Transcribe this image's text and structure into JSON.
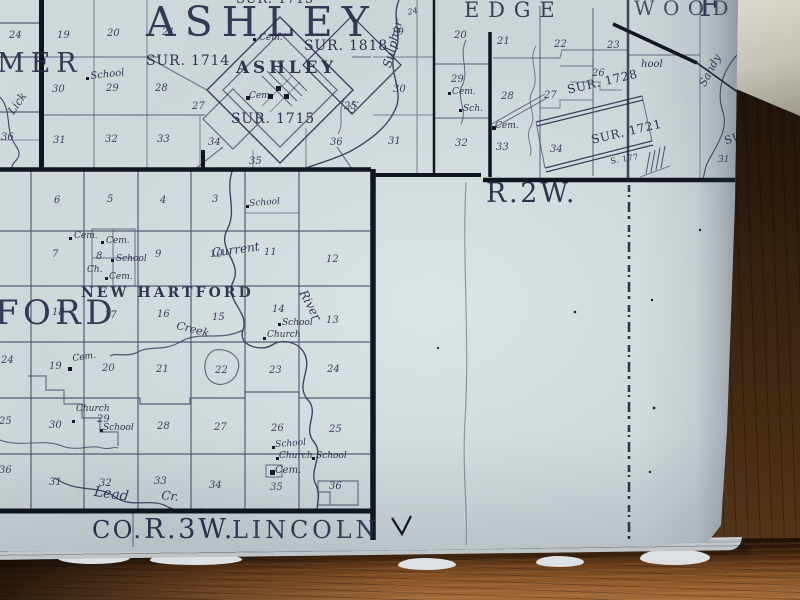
{
  "colors": {
    "ink": "#212b46",
    "ink_heavy": "#10151f",
    "paper": "#ccd4d8",
    "paper_bright": "#d8dfe2",
    "wood_dark": "#2e1a0c",
    "wood_mid": "#5a3a1d",
    "wood_light": "#9a6233",
    "object_light": "#dcd9cf"
  },
  "map": {
    "border_labels": {
      "range_right": "R.2W.",
      "bottom_county": "CO.",
      "bottom_range": "R.3W.",
      "bottom_township": "LINCOLN"
    },
    "labels": [
      {
        "n": "survey-label",
        "t": "SUR. 1715",
        "x": 236,
        "y": -7,
        "fs": 13,
        "c": "sur"
      },
      {
        "n": "township-name-ashley",
        "t": "ASHLEY",
        "x": 146,
        "y": 2,
        "fs": 41,
        "c": "big"
      },
      {
        "n": "township-name-partial-mer",
        "t": "MER",
        "x": -3,
        "y": 50,
        "fs": 27,
        "c": "big"
      },
      {
        "n": "section-number",
        "t": "24",
        "x": 9,
        "y": 31,
        "c": "num"
      },
      {
        "n": "section-number",
        "t": "19",
        "x": 57,
        "y": 31,
        "c": "num"
      },
      {
        "n": "section-number",
        "t": "20",
        "x": 107,
        "y": 29,
        "c": "num"
      },
      {
        "n": "section-number",
        "t": "21",
        "x": 162,
        "y": 28,
        "c": "num"
      },
      {
        "n": "poi-label",
        "t": "School",
        "x": 90,
        "y": 72,
        "fs": 10,
        "c": "cur",
        "r": -6
      },
      {
        "n": "creek-name",
        "t": "Lick",
        "x": 6,
        "y": 110,
        "fs": 11,
        "c": "cur",
        "r": -55
      },
      {
        "n": "section-number",
        "t": "30",
        "x": 52,
        "y": 85,
        "c": "num"
      },
      {
        "n": "section-number",
        "t": "29",
        "x": 106,
        "y": 84,
        "c": "num"
      },
      {
        "n": "section-number",
        "t": "28",
        "x": 155,
        "y": 84,
        "c": "num"
      },
      {
        "n": "section-number",
        "t": "27",
        "x": 192,
        "y": 102,
        "c": "num"
      },
      {
        "n": "section-number",
        "t": "25",
        "x": 344,
        "y": 102,
        "c": "num"
      },
      {
        "n": "section-number",
        "t": "36",
        "x": 1,
        "y": 133,
        "c": "num"
      },
      {
        "n": "section-number",
        "t": "31",
        "x": 53,
        "y": 136,
        "c": "num"
      },
      {
        "n": "section-number",
        "t": "32",
        "x": 105,
        "y": 135,
        "c": "num"
      },
      {
        "n": "section-number",
        "t": "33",
        "x": 157,
        "y": 135,
        "c": "num"
      },
      {
        "n": "section-number",
        "t": "34",
        "x": 208,
        "y": 138,
        "c": "num"
      },
      {
        "n": "section-number",
        "t": "35",
        "x": 249,
        "y": 157,
        "c": "num"
      },
      {
        "n": "section-number",
        "t": "36",
        "x": 330,
        "y": 138,
        "c": "num"
      },
      {
        "n": "section-number",
        "t": "31",
        "x": 388,
        "y": 137,
        "c": "num"
      },
      {
        "n": "section-number",
        "t": "30",
        "x": 393,
        "y": 85,
        "c": "num"
      },
      {
        "n": "section-number",
        "t": "19",
        "x": 391,
        "y": 28,
        "c": "num"
      },
      {
        "n": "section-number",
        "t": "24",
        "x": 407,
        "y": 9,
        "fs": 8,
        "c": "num",
        "r": -12
      },
      {
        "n": "survey-label",
        "t": "SUR. 1714",
        "x": 146,
        "y": 54,
        "fs": 14,
        "c": "sur"
      },
      {
        "n": "survey-label",
        "t": "SUR. 1818",
        "x": 304,
        "y": 39,
        "fs": 14,
        "c": "sur"
      },
      {
        "n": "town-name-ashley",
        "t": "ASHLEY",
        "x": 236,
        "y": 60,
        "fs": 17,
        "c": "twn"
      },
      {
        "n": "survey-label",
        "t": "SUR. 1715",
        "x": 231,
        "y": 112,
        "fs": 14,
        "c": "sur"
      },
      {
        "n": "poi-label",
        "t": "Cem.",
        "x": 259,
        "y": 34,
        "c": "hand"
      },
      {
        "n": "poi-label",
        "t": "Cem.",
        "x": 249,
        "y": 92,
        "c": "hand"
      },
      {
        "n": "creek-name",
        "t": "Sulphur",
        "x": 381,
        "y": 66,
        "fs": 12,
        "c": "cur",
        "r": -76
      },
      {
        "n": "creek-name",
        "t": "Cr.",
        "x": 347,
        "y": 112,
        "fs": 10,
        "c": "cur",
        "r": -68
      },
      {
        "n": "township-name-edgewood",
        "t": "EDGE",
        "x": 464,
        "y": 0,
        "fs": 21,
        "c": "twn2"
      },
      {
        "n": "township-name-edgewood",
        "t": "WOOD",
        "x": 634,
        "y": -2,
        "fs": 20,
        "c": "twn2",
        "o": 0.78
      },
      {
        "n": "township-letter",
        "t": "F",
        "x": 699,
        "y": -8,
        "fs": 30,
        "c": "twn2"
      },
      {
        "n": "section-number",
        "t": "20",
        "x": 454,
        "y": 31,
        "c": "num"
      },
      {
        "n": "section-number",
        "t": "21",
        "x": 497,
        "y": 37,
        "c": "num"
      },
      {
        "n": "section-number",
        "t": "22",
        "x": 554,
        "y": 40,
        "c": "num"
      },
      {
        "n": "section-number",
        "t": "23",
        "x": 607,
        "y": 41,
        "c": "num"
      },
      {
        "n": "section-number",
        "t": "29",
        "x": 451,
        "y": 75,
        "c": "num"
      },
      {
        "n": "section-number",
        "t": "28",
        "x": 501,
        "y": 92,
        "c": "num"
      },
      {
        "n": "section-number",
        "t": "27",
        "x": 544,
        "y": 91,
        "c": "num"
      },
      {
        "n": "section-number",
        "t": "26",
        "x": 592,
        "y": 69,
        "c": "num"
      },
      {
        "n": "section-number",
        "t": "32",
        "x": 455,
        "y": 139,
        "c": "num"
      },
      {
        "n": "section-number",
        "t": "33",
        "x": 496,
        "y": 143,
        "c": "num"
      },
      {
        "n": "section-number",
        "t": "34",
        "x": 550,
        "y": 145,
        "c": "num"
      },
      {
        "n": "poi-label",
        "t": "Cem.",
        "x": 452,
        "y": 88,
        "c": "hand"
      },
      {
        "n": "poi-label",
        "t": "Sch.",
        "x": 463,
        "y": 105,
        "c": "hand"
      },
      {
        "n": "poi-label",
        "t": "Cem.",
        "x": 495,
        "y": 122,
        "c": "hand"
      },
      {
        "n": "poi-label",
        "t": "hool",
        "x": 641,
        "y": 60,
        "fs": 10,
        "c": "hand"
      },
      {
        "n": "survey-label",
        "t": "SUR. 1728",
        "x": 566,
        "y": 84,
        "fs": 12,
        "c": "sur",
        "r": -13
      },
      {
        "n": "survey-label",
        "t": "SUR. 1721",
        "x": 590,
        "y": 134,
        "fs": 12,
        "c": "sur",
        "r": -13
      },
      {
        "n": "survey-label",
        "t": "S. 177",
        "x": 610,
        "y": 158,
        "fs": 8,
        "c": "sur",
        "r": -10
      },
      {
        "n": "creek-name",
        "t": "Sandy",
        "x": 697,
        "y": 83,
        "fs": 11,
        "c": "cur",
        "r": -62
      },
      {
        "n": "survey-label",
        "t": "SU",
        "x": 723,
        "y": 136,
        "fs": 11,
        "c": "sur",
        "r": -18
      },
      {
        "n": "section-number",
        "t": "31",
        "x": 718,
        "y": 156,
        "fs": 9,
        "c": "num"
      },
      {
        "n": "range-label",
        "t": "R.2W.",
        "x": 486,
        "y": 180,
        "fs": 27,
        "c": "bl"
      },
      {
        "n": "section-number",
        "t": "6",
        "x": 54,
        "y": 196,
        "c": "num"
      },
      {
        "n": "section-number",
        "t": "5",
        "x": 107,
        "y": 195,
        "c": "num"
      },
      {
        "n": "section-number",
        "t": "4",
        "x": 160,
        "y": 196,
        "c": "num"
      },
      {
        "n": "section-number",
        "t": "3",
        "x": 212,
        "y": 195,
        "c": "num"
      },
      {
        "n": "poi-label",
        "t": "School",
        "x": 249,
        "y": 200,
        "fs": 9,
        "c": "cur",
        "r": -4
      },
      {
        "n": "section-number",
        "t": "7",
        "x": 52,
        "y": 250,
        "c": "num"
      },
      {
        "n": "section-number",
        "t": "8",
        "x": 96,
        "y": 252,
        "c": "num"
      },
      {
        "n": "section-number",
        "t": "9",
        "x": 155,
        "y": 250,
        "c": "num"
      },
      {
        "n": "section-number",
        "t": "10",
        "x": 210,
        "y": 250,
        "c": "num"
      },
      {
        "n": "section-number",
        "t": "11",
        "x": 264,
        "y": 248,
        "c": "num"
      },
      {
        "n": "section-number",
        "t": "12",
        "x": 326,
        "y": 255,
        "c": "num"
      },
      {
        "n": "poi-label",
        "t": "Cem.",
        "x": 74,
        "y": 232,
        "c": "hand"
      },
      {
        "n": "poi-label",
        "t": "Cem.",
        "x": 106,
        "y": 237,
        "c": "hand"
      },
      {
        "n": "poi-label",
        "t": "School",
        "x": 116,
        "y": 255,
        "c": "hand"
      },
      {
        "n": "poi-label",
        "t": "Ch.",
        "x": 87,
        "y": 266,
        "c": "hand"
      },
      {
        "n": "poi-label",
        "t": "Cem.",
        "x": 109,
        "y": 273,
        "c": "hand"
      },
      {
        "n": "town-name-new-hartford",
        "t": "NEW HARTFORD",
        "x": 81,
        "y": 286,
        "fs": 14,
        "c": "twn"
      },
      {
        "n": "township-name-ford",
        "t": "FORD",
        "x": -5,
        "y": 296,
        "fs": 34,
        "c": "big3"
      },
      {
        "n": "river-name",
        "t": "Current",
        "x": 211,
        "y": 247,
        "fs": 12,
        "c": "cur",
        "r": -8
      },
      {
        "n": "section-number",
        "t": "18",
        "x": 52,
        "y": 308,
        "c": "num"
      },
      {
        "n": "section-number",
        "t": "17",
        "x": 104,
        "y": 311,
        "c": "num"
      },
      {
        "n": "section-number",
        "t": "16",
        "x": 157,
        "y": 310,
        "c": "num"
      },
      {
        "n": "section-number",
        "t": "15",
        "x": 212,
        "y": 313,
        "c": "num"
      },
      {
        "n": "section-number",
        "t": "14",
        "x": 272,
        "y": 305,
        "c": "num"
      },
      {
        "n": "section-number",
        "t": "13",
        "x": 326,
        "y": 316,
        "c": "num"
      },
      {
        "n": "creek-name",
        "t": "Creek",
        "x": 178,
        "y": 320,
        "fs": 11,
        "c": "cur",
        "r": 14
      },
      {
        "n": "river-name",
        "t": "River",
        "x": 308,
        "y": 288,
        "fs": 12,
        "c": "cur",
        "r": 62
      },
      {
        "n": "poi-label",
        "t": "School",
        "x": 282,
        "y": 319,
        "c": "hand"
      },
      {
        "n": "poi-label",
        "t": "Church",
        "x": 267,
        "y": 331,
        "c": "hand"
      },
      {
        "n": "section-number",
        "t": "19",
        "x": 49,
        "y": 362,
        "c": "num"
      },
      {
        "n": "section-number",
        "t": "20",
        "x": 102,
        "y": 364,
        "c": "num"
      },
      {
        "n": "section-number",
        "t": "21",
        "x": 156,
        "y": 365,
        "c": "num"
      },
      {
        "n": "section-number",
        "t": "22",
        "x": 215,
        "y": 366,
        "c": "num"
      },
      {
        "n": "section-number",
        "t": "23",
        "x": 269,
        "y": 366,
        "c": "num"
      },
      {
        "n": "section-number",
        "t": "24",
        "x": 327,
        "y": 365,
        "c": "num"
      },
      {
        "n": "poi-label",
        "t": "Cem.",
        "x": 72,
        "y": 355,
        "c": "hand",
        "r": -8
      },
      {
        "n": "section-number",
        "t": "24",
        "x": 1,
        "y": 356,
        "c": "num"
      },
      {
        "n": "section-number",
        "t": "25",
        "x": -1,
        "y": 417,
        "c": "num"
      },
      {
        "n": "section-number",
        "t": "36",
        "x": -1,
        "y": 466,
        "c": "num"
      },
      {
        "n": "section-number",
        "t": "30",
        "x": 49,
        "y": 421,
        "c": "num"
      },
      {
        "n": "section-number",
        "t": "29",
        "x": 97,
        "y": 415,
        "c": "num"
      },
      {
        "n": "section-number",
        "t": "28",
        "x": 157,
        "y": 422,
        "c": "num"
      },
      {
        "n": "section-number",
        "t": "27",
        "x": 214,
        "y": 423,
        "c": "num"
      },
      {
        "n": "section-number",
        "t": "26",
        "x": 271,
        "y": 424,
        "c": "num"
      },
      {
        "n": "section-number",
        "t": "25",
        "x": 329,
        "y": 425,
        "c": "num"
      },
      {
        "n": "poi-label",
        "t": "Church",
        "x": 76,
        "y": 405,
        "c": "hand"
      },
      {
        "n": "poi-label",
        "t": "School",
        "x": 103,
        "y": 424,
        "c": "hand"
      },
      {
        "n": "poi-label",
        "t": "School",
        "x": 275,
        "y": 441,
        "fs": 9,
        "c": "cur",
        "r": -4
      },
      {
        "n": "section-number",
        "t": "31",
        "x": 49,
        "y": 478,
        "c": "num"
      },
      {
        "n": "section-number",
        "t": "32",
        "x": 99,
        "y": 479,
        "c": "num"
      },
      {
        "n": "section-number",
        "t": "33",
        "x": 154,
        "y": 477,
        "c": "num"
      },
      {
        "n": "section-number",
        "t": "34",
        "x": 209,
        "y": 481,
        "c": "num"
      },
      {
        "n": "section-number",
        "t": "35",
        "x": 270,
        "y": 483,
        "c": "num"
      },
      {
        "n": "section-number",
        "t": "36",
        "x": 329,
        "y": 482,
        "c": "num"
      },
      {
        "n": "poi-label",
        "t": "Church",
        "x": 279,
        "y": 452,
        "c": "hand"
      },
      {
        "n": "poi-label",
        "t": "School",
        "x": 316,
        "y": 452,
        "c": "hand"
      },
      {
        "n": "poi-label",
        "t": "Cem.",
        "x": 275,
        "y": 466,
        "fs": 10,
        "c": "hand"
      },
      {
        "n": "creek-name",
        "t": "Lead",
        "x": 95,
        "y": 485,
        "fs": 14,
        "c": "cur",
        "r": 8
      },
      {
        "n": "creek-name",
        "t": "Cr.",
        "x": 162,
        "y": 489,
        "fs": 12,
        "c": "cur",
        "r": 6
      },
      {
        "n": "county-label",
        "t": "CO.",
        "x": 92,
        "y": 518,
        "fs": 24,
        "c": "bl"
      },
      {
        "n": "range-label-bottom",
        "t": "R.3W.",
        "x": 144,
        "y": 516,
        "fs": 27,
        "c": "bl"
      },
      {
        "n": "township-label-lincoln",
        "t": "LINCOLN",
        "x": 232,
        "y": 518,
        "fs": 24,
        "c": "bl3"
      }
    ],
    "markers": [
      [
        253,
        38,
        3
      ],
      [
        246,
        96,
        4
      ],
      [
        86,
        77,
        3
      ],
      [
        448,
        92,
        3
      ],
      [
        459,
        109,
        3
      ],
      [
        492,
        126,
        3.5
      ],
      [
        276,
        86,
        5
      ],
      [
        284,
        94,
        5
      ],
      [
        268,
        94,
        5
      ],
      [
        69,
        237,
        3
      ],
      [
        101,
        241,
        3
      ],
      [
        111,
        259,
        3
      ],
      [
        105,
        277,
        3
      ],
      [
        246,
        205,
        3
      ],
      [
        278,
        323,
        3
      ],
      [
        263,
        337,
        3
      ],
      [
        68,
        367,
        4
      ],
      [
        72,
        420,
        3
      ],
      [
        100,
        429,
        3
      ],
      [
        272,
        446,
        3
      ],
      [
        276,
        457,
        3
      ],
      [
        312,
        457,
        3
      ],
      [
        270,
        470,
        4.5
      ]
    ]
  }
}
